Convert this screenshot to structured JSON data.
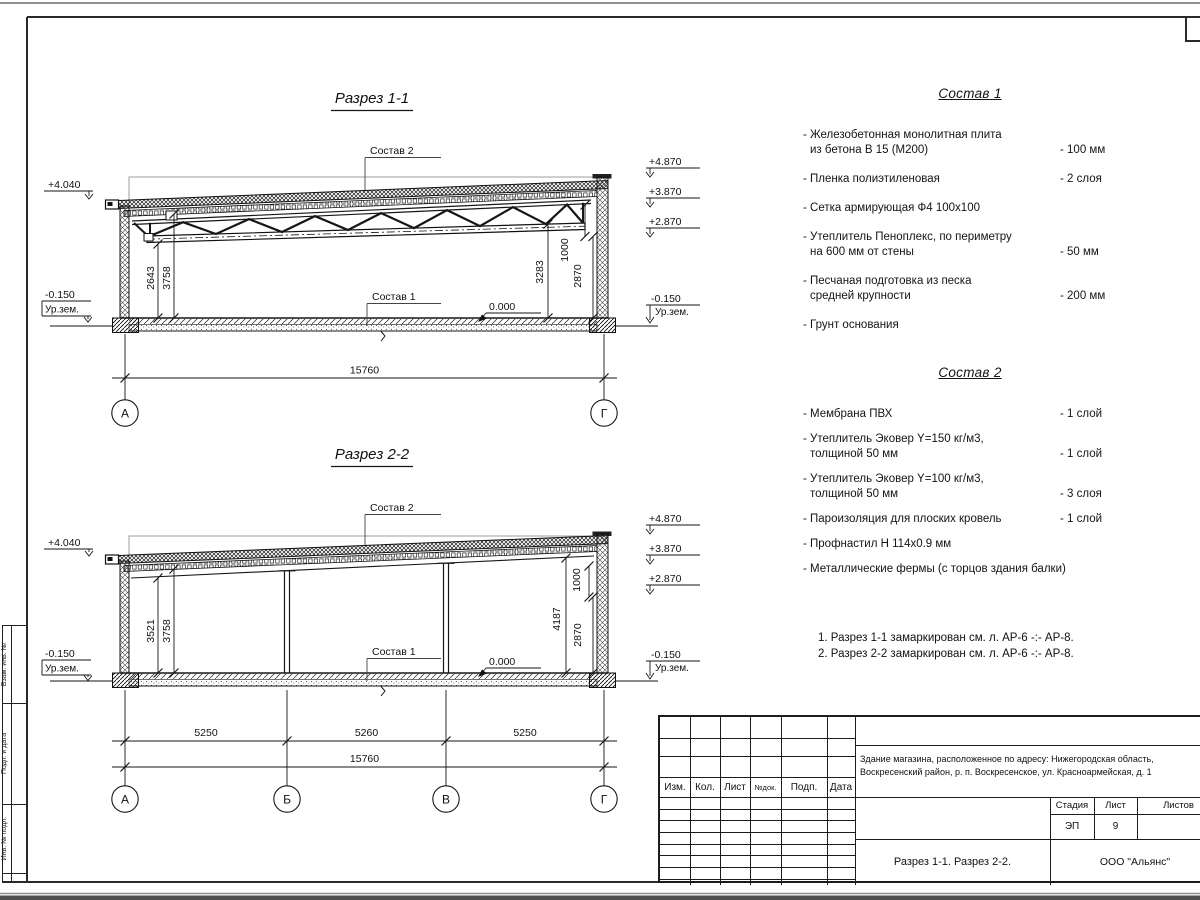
{
  "sec1": {
    "title": "Разрез 1-1",
    "leader_top": "Состав 2",
    "leader_floor": "Состав 1",
    "zero": "0.000",
    "elev": {
      "left_top": "+4.040",
      "left_minus": "-0.150",
      "ground": "Ур.зем.",
      "r1": "+4.870",
      "r2": "+3.870",
      "r3": "+2.870",
      "r_minus": "-0.150"
    },
    "dims": {
      "v1": "2643",
      "v2": "3758",
      "v3": "3283",
      "v4": "1000",
      "v5": "2870",
      "total": "15760"
    },
    "axes": {
      "a1": "А",
      "a2": "Г"
    }
  },
  "sec2": {
    "title": "Разрез 2-2",
    "leader_top": "Состав 2",
    "leader_floor": "Состав 1",
    "zero": "0.000",
    "elev": {
      "left_top": "+4.040",
      "left_minus": "-0.150",
      "ground": "Ур.зем.",
      "r1": "+4.870",
      "r2": "+3.870",
      "r3": "+2.870",
      "r_minus": "-0.150"
    },
    "dims": {
      "v1": "3521",
      "v2": "3758",
      "v3": "4187",
      "v4": "1000",
      "v5": "2870",
      "s1": "5250",
      "s2": "5260",
      "s3": "5250",
      "total": "15760"
    },
    "axes": {
      "a1": "А",
      "a2": "Б",
      "a3": "В",
      "a4": "Г"
    }
  },
  "sostav1": {
    "title": "Состав 1",
    "items": [
      {
        "l1": "- Железобетонная  монолитная плита",
        "l2": "из бетона В 15 (М200)",
        "val": "- 100 мм"
      },
      {
        "l1": "- Пленка полиэтиленовая",
        "val": "- 2 слоя"
      },
      {
        "l1": "- Сетка армирующая Ф4 100х100"
      },
      {
        "l1": "- Утеплитель Пеноплекс, по периметру",
        "l2": "на 600 мм от стены",
        "val": "- 50 мм"
      },
      {
        "l1": "- Песчаная подготовка из песка",
        "l2": "средней крупности",
        "val": "- 200 мм"
      },
      {
        "l1": "- Грунт основания"
      }
    ]
  },
  "sostav2": {
    "title": "Состав 2",
    "items": [
      {
        "l1": "- Мембрана ПВХ",
        "val": "- 1 слой"
      },
      {
        "l1": "- Утеплитель Эковер Y=150 кг/м3,",
        "l2": "толщиной 50 мм",
        "val": "- 1 слой"
      },
      {
        "l1": "- Утеплитель Эковер Y=100 кг/м3,",
        "l2": "толщиной 50 мм",
        "val": "- 3 слоя"
      },
      {
        "l1": "- Пароизоляция для плоских кровель",
        "val": "- 1 слой"
      },
      {
        "l1": "- Профнастил Н 114х0.9 мм"
      },
      {
        "l1": "- Металлические фермы (с торцов здания балки)"
      }
    ]
  },
  "notes": {
    "n1": "1. Разрез 1-1 замаркирован см. л. АР-6 -:- АР-8.",
    "n2": "2. Разрез 2-2 замаркирован см. л. АР-6 -:- АР-8."
  },
  "titleblock": {
    "col1": "Изм.",
    "col2": "Кол.",
    "col3": "Лист",
    "col4": "№док.",
    "col5": "Подп.",
    "col6": "Дата",
    "project1": "Здание магазина, расположенное по адресу: Нижегородская область,",
    "project2": "Воскресенский район, р. п. Воскресенское, ул. Красноармейская, д. 1",
    "stage_label": "Стадия",
    "sheet_label": "Лист",
    "sheets_label": "Листов",
    "stage": "ЭП",
    "sheet": "9",
    "doc_title": "Разрез 1-1. Разрез 2-2.",
    "company": "ООО \"Альянс\""
  },
  "frame": {
    "stamp1": "Взам. инв. №",
    "stamp2": "Подп. и дата",
    "stamp3": "Инв. № подл."
  }
}
